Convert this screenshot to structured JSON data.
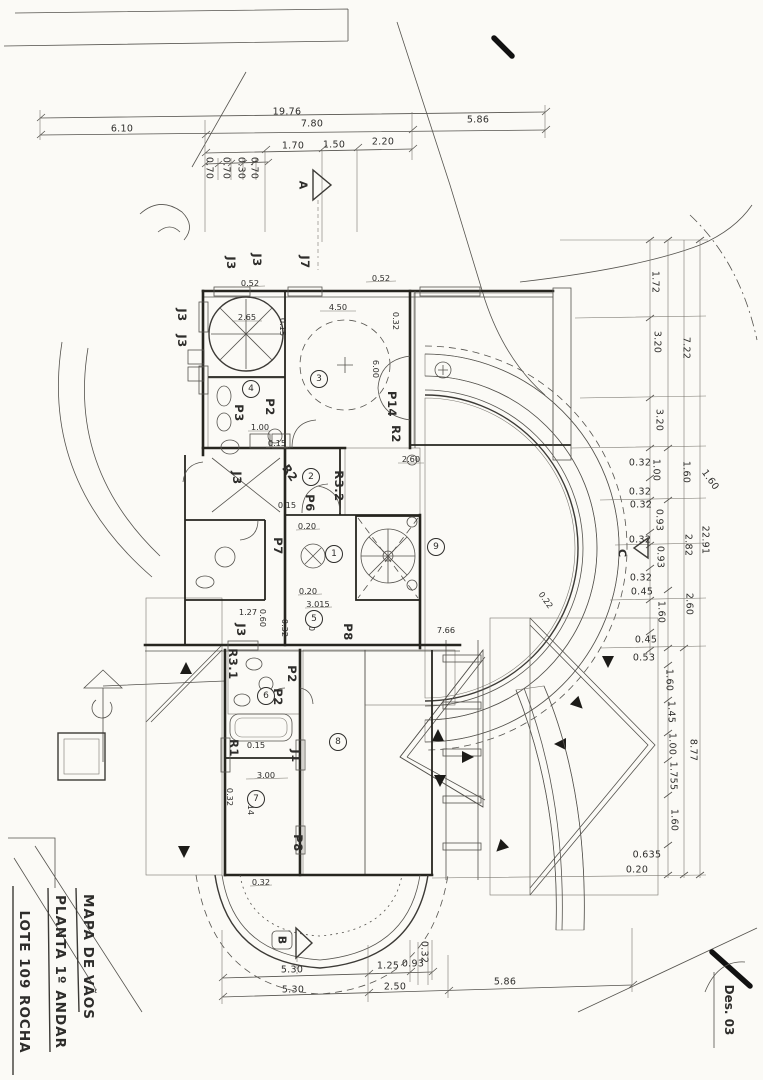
{
  "title_block": {
    "lines": [
      {
        "t": "MAPA DE VÃOS",
        "x": 88,
        "y": 957,
        "r": 90,
        "n": "title-line-1"
      },
      {
        "t": "PLANTA 1º ANDAR",
        "x": 60,
        "y": 972,
        "r": 90,
        "n": "title-line-2"
      },
      {
        "t": "LOTE 109 ROCHA",
        "x": 24,
        "y": 982,
        "r": 90,
        "n": "title-line-3"
      }
    ],
    "annotations": [
      {
        "t": "Des. 03",
        "x": 729,
        "y": 1010,
        "r": 90,
        "n": "drawing-number"
      }
    ]
  },
  "section_markers": [
    {
      "t": "A",
      "x": 303,
      "y": 185,
      "r": 90,
      "n": "section-marker-a"
    },
    {
      "t": "B",
      "x": 282,
      "y": 940,
      "r": 90,
      "n": "section-marker-b"
    },
    {
      "t": "C",
      "x": 622,
      "y": 553,
      "r": 90,
      "n": "section-marker-c"
    }
  ],
  "labels": {
    "dims_top": [
      {
        "t": "19.76",
        "x": 287,
        "y": 112
      },
      {
        "t": "6.10",
        "x": 122,
        "y": 129
      },
      {
        "t": "7.80",
        "x": 312,
        "y": 124
      },
      {
        "t": "5.86",
        "x": 478,
        "y": 120
      },
      {
        "t": "1.70",
        "x": 293,
        "y": 146
      },
      {
        "t": "1.50",
        "x": 334,
        "y": 145
      },
      {
        "t": "2.20",
        "x": 383,
        "y": 142
      },
      {
        "t": "0.70",
        "x": 209,
        "y": 168,
        "r": 90
      },
      {
        "t": "0.70",
        "x": 226,
        "y": 168,
        "r": 90
      },
      {
        "t": "0.30",
        "x": 241,
        "y": 168,
        "r": 90
      },
      {
        "t": "0.70",
        "x": 254,
        "y": 168,
        "r": 90
      }
    ],
    "dims_right": [
      {
        "t": "1.72",
        "x": 655,
        "y": 282,
        "r": 90
      },
      {
        "t": "3.20",
        "x": 657,
        "y": 342,
        "r": 90
      },
      {
        "t": "3.20",
        "x": 659,
        "y": 420,
        "r": 90
      },
      {
        "t": "0.32",
        "x": 640,
        "y": 463
      },
      {
        "t": "1.00",
        "x": 656,
        "y": 470,
        "r": 90
      },
      {
        "t": "0.32",
        "x": 640,
        "y": 492
      },
      {
        "t": "0.32",
        "x": 641,
        "y": 505
      },
      {
        "t": "0.93",
        "x": 659,
        "y": 520,
        "r": 90
      },
      {
        "t": "0.32",
        "x": 640,
        "y": 540
      },
      {
        "t": "0.93",
        "x": 660,
        "y": 557,
        "r": 90
      },
      {
        "t": "0.32",
        "x": 641,
        "y": 578
      },
      {
        "t": "0.45",
        "x": 642,
        "y": 592
      },
      {
        "t": "1.60",
        "x": 661,
        "y": 612,
        "r": 90
      },
      {
        "t": "0.45",
        "x": 646,
        "y": 640
      },
      {
        "t": "0.53",
        "x": 644,
        "y": 658
      },
      {
        "t": "1.60",
        "x": 669,
        "y": 680,
        "r": 90
      },
      {
        "t": "1.45",
        "x": 671,
        "y": 712,
        "r": 90
      },
      {
        "t": "1.00",
        "x": 672,
        "y": 744,
        "r": 90
      },
      {
        "t": "1.755",
        "x": 673,
        "y": 776,
        "r": 90
      },
      {
        "t": "1.60",
        "x": 674,
        "y": 820,
        "r": 90
      },
      {
        "t": "0.635",
        "x": 647,
        "y": 855
      },
      {
        "t": "0.20",
        "x": 637,
        "y": 870
      },
      {
        "t": "7.22",
        "x": 686,
        "y": 348,
        "r": 90
      },
      {
        "t": "1.60",
        "x": 686,
        "y": 472,
        "r": 90
      },
      {
        "t": "2.82",
        "x": 688,
        "y": 545,
        "r": 90
      },
      {
        "t": "2.60",
        "x": 689,
        "y": 604,
        "r": 90
      },
      {
        "t": "8.77",
        "x": 693,
        "y": 750,
        "r": 90
      },
      {
        "t": "22.91",
        "x": 705,
        "y": 540,
        "r": 90
      },
      {
        "t": "1.60",
        "x": 710,
        "y": 480,
        "r": 55
      }
    ],
    "dims_bottom": [
      {
        "t": "5.30",
        "x": 292,
        "y": 970
      },
      {
        "t": "1.25",
        "x": 388,
        "y": 966
      },
      {
        "t": "0.93",
        "x": 413,
        "y": 964
      },
      {
        "t": "0.32",
        "x": 424,
        "y": 952,
        "r": 90
      },
      {
        "t": "5.30",
        "x": 293,
        "y": 990
      },
      {
        "t": "2.50",
        "x": 395,
        "y": 987
      },
      {
        "t": "5.86",
        "x": 505,
        "y": 982
      }
    ],
    "dims_inner": [
      {
        "t": "0.52",
        "x": 250,
        "y": 283
      },
      {
        "t": "0.52",
        "x": 381,
        "y": 278
      },
      {
        "t": "0.32",
        "x": 396,
        "y": 321,
        "r": 90
      },
      {
        "t": "4.50",
        "x": 338,
        "y": 307
      },
      {
        "t": "2.65",
        "x": 247,
        "y": 317
      },
      {
        "t": "0.15",
        "x": 283,
        "y": 327,
        "r": 90
      },
      {
        "t": "6.00",
        "x": 376,
        "y": 369,
        "r": 90
      },
      {
        "t": "1.00",
        "x": 260,
        "y": 427
      },
      {
        "t": "0.15",
        "x": 277,
        "y": 443
      },
      {
        "t": "2.60",
        "x": 411,
        "y": 459
      },
      {
        "t": "0.15",
        "x": 287,
        "y": 505
      },
      {
        "t": "0.20",
        "x": 307,
        "y": 526
      },
      {
        "t": "0.20",
        "x": 308,
        "y": 591
      },
      {
        "t": "3.015",
        "x": 318,
        "y": 604
      },
      {
        "t": "2.00",
        "x": 312,
        "y": 622,
        "r": 90
      },
      {
        "t": "0.32",
        "x": 285,
        "y": 628,
        "r": 90
      },
      {
        "t": "0.60",
        "x": 263,
        "y": 618,
        "r": 90
      },
      {
        "t": "1.27",
        "x": 248,
        "y": 612
      },
      {
        "t": "0.15",
        "x": 256,
        "y": 745
      },
      {
        "t": "3.00",
        "x": 266,
        "y": 775
      },
      {
        "t": "5.14",
        "x": 251,
        "y": 806,
        "r": 90
      },
      {
        "t": "0.32",
        "x": 230,
        "y": 797,
        "r": 90
      },
      {
        "t": "0.32",
        "x": 261,
        "y": 882
      },
      {
        "t": "7.66",
        "x": 446,
        "y": 630
      },
      {
        "t": "0.22",
        "x": 546,
        "y": 600,
        "r": 55
      }
    ],
    "openings": [
      {
        "t": "J3",
        "x": 231,
        "y": 263,
        "r": 90
      },
      {
        "t": "J3",
        "x": 257,
        "y": 260,
        "r": 90
      },
      {
        "t": "J7",
        "x": 305,
        "y": 262,
        "r": 90
      },
      {
        "t": "J3",
        "x": 182,
        "y": 315,
        "r": 90
      },
      {
        "t": "J3",
        "x": 182,
        "y": 341,
        "r": 90
      },
      {
        "t": "J3",
        "x": 237,
        "y": 478,
        "r": 90
      },
      {
        "t": "J3",
        "x": 241,
        "y": 630,
        "r": 90
      },
      {
        "t": "J1",
        "x": 296,
        "y": 756,
        "r": 90
      },
      {
        "t": "P2",
        "x": 270,
        "y": 407,
        "r": 90
      },
      {
        "t": "P3",
        "x": 239,
        "y": 413,
        "r": 90
      },
      {
        "t": "P2",
        "x": 292,
        "y": 674,
        "r": 90
      },
      {
        "t": "P2",
        "x": 278,
        "y": 697,
        "r": 90
      },
      {
        "t": "P6",
        "x": 310,
        "y": 503,
        "r": 90
      },
      {
        "t": "P7",
        "x": 278,
        "y": 546,
        "r": 90
      },
      {
        "t": "P8",
        "x": 348,
        "y": 632,
        "r": 90
      },
      {
        "t": "P8",
        "x": 298,
        "y": 843,
        "r": 90
      },
      {
        "t": "P14",
        "x": 392,
        "y": 404,
        "r": 90
      },
      {
        "t": "R2",
        "x": 396,
        "y": 434,
        "r": 90
      },
      {
        "t": "R2",
        "x": 290,
        "y": 473,
        "r": 55
      },
      {
        "t": "R3.2",
        "x": 339,
        "y": 486,
        "r": 90
      },
      {
        "t": "R3.1",
        "x": 233,
        "y": 664,
        "r": 90
      },
      {
        "t": "R1",
        "x": 234,
        "y": 748,
        "r": 90
      }
    ],
    "rooms": [
      {
        "t": "1",
        "x": 334,
        "y": 554
      },
      {
        "t": "2",
        "x": 311,
        "y": 477
      },
      {
        "t": "3",
        "x": 319,
        "y": 379
      },
      {
        "t": "4",
        "x": 251,
        "y": 389
      },
      {
        "t": "5",
        "x": 314,
        "y": 619
      },
      {
        "t": "6",
        "x": 266,
        "y": 696
      },
      {
        "t": "7",
        "x": 256,
        "y": 799
      },
      {
        "t": "8",
        "x": 338,
        "y": 742
      },
      {
        "t": "9",
        "x": 436,
        "y": 547
      }
    ]
  }
}
